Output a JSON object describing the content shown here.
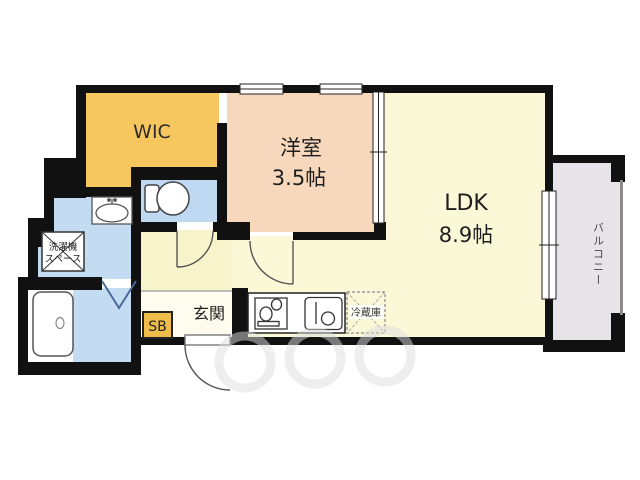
{
  "plan": {
    "title": "apartment-floor-plan",
    "rooms": {
      "wic": {
        "label": "WIC"
      },
      "western_room": {
        "label": "洋室",
        "area": "3.5帖"
      },
      "ldk": {
        "label": "LDK",
        "area": "8.9帖"
      },
      "balcony": {
        "label": "バルコニー"
      },
      "entrance": {
        "label": "玄関"
      },
      "shoe_box": {
        "label": "SB"
      },
      "washer_space": {
        "line1": "洗濯機",
        "line2": "スペース"
      },
      "refrigerator": {
        "label": "冷蔵庫"
      }
    },
    "colors": {
      "wall": "#111111",
      "wic_fill": "#F6C75F",
      "western_room_fill": "#F8D8BD",
      "ldk_fill": "#FAF8D7",
      "entrance_fill": "#FDFCEE",
      "water_room_fill": "#BFD9F2",
      "balcony_fill": "#E6E4E8",
      "shoe_box_fill": "#EFBE4A"
    }
  }
}
